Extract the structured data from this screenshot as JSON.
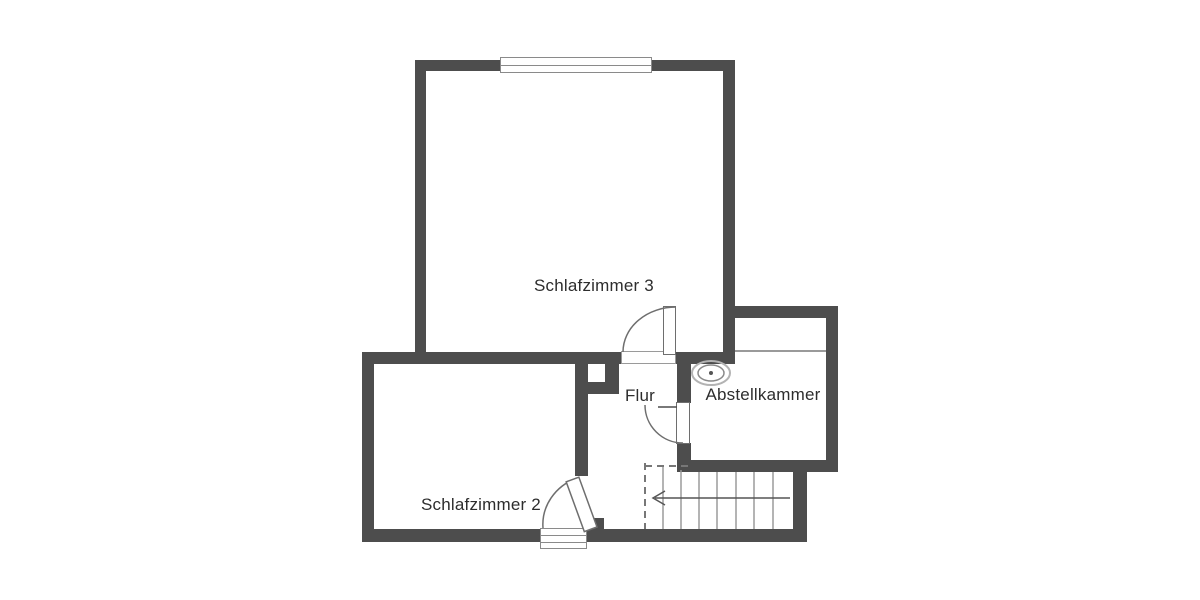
{
  "meta": {
    "type": "floor-plan",
    "language": "de"
  },
  "colors": {
    "background": "#ffffff",
    "wall": "#4d4d4d",
    "thin_line": "#9a9a9a",
    "symbol_line": "#8a8a8a",
    "text": "#2d2d2d"
  },
  "rooms": [
    {
      "id": "schlafzimmer-3",
      "label": "Schlafzimmer 3"
    },
    {
      "id": "schlafzimmer-2",
      "label": "Schlafzimmer 2"
    },
    {
      "id": "flur",
      "label": "Flur"
    },
    {
      "id": "abstellkammer",
      "label": "Abstellkammer"
    }
  ],
  "features": {
    "windows": 2,
    "doors": 3,
    "stairs": {
      "treads": 8,
      "direction_arrow": "left"
    },
    "symbols": [
      "ceiling-lamp",
      "chimney-shaft",
      "roof-slope-line"
    ]
  }
}
